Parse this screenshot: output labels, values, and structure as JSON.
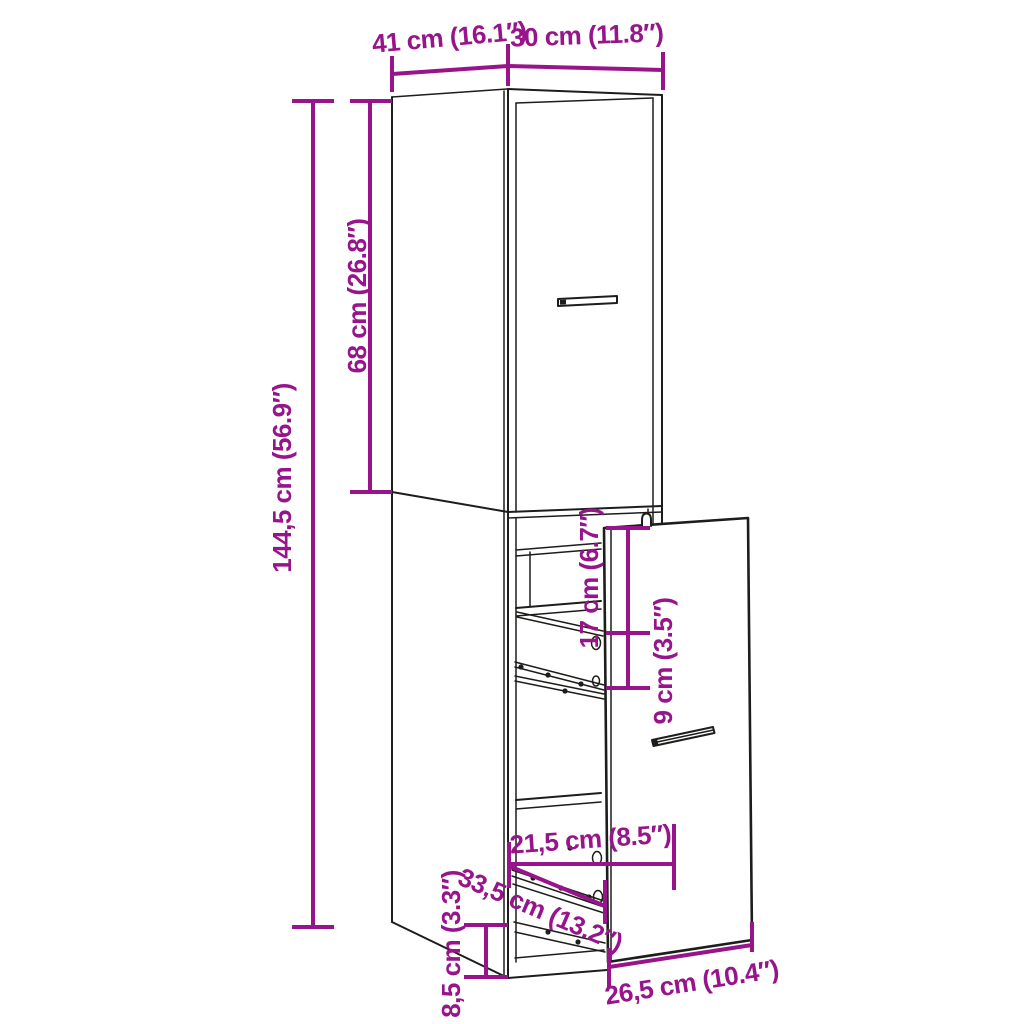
{
  "diagram": {
    "colors": {
      "dimension_annotation": "#97148B",
      "line_art": "#1D1D1B",
      "background": "#FFFFFF"
    },
    "dimensions": {
      "top_depth": "41 cm (16.1″)",
      "top_width": "30 cm (11.8″)",
      "total_height": "144,5 cm (56.9″)",
      "upper_door_height": "68 cm (26.8″)",
      "top_drawer_clearance": "17 cm (6.7″)",
      "drawer_gap": "9 cm (3.5″)",
      "inner_width": "21,5 cm (8.5″)",
      "pullout_extension": "33,5 cm (13.2″)",
      "base_height": "8,5 cm (3.3″)",
      "drawer_front_width": "26,5 cm (10.4″)"
    }
  }
}
